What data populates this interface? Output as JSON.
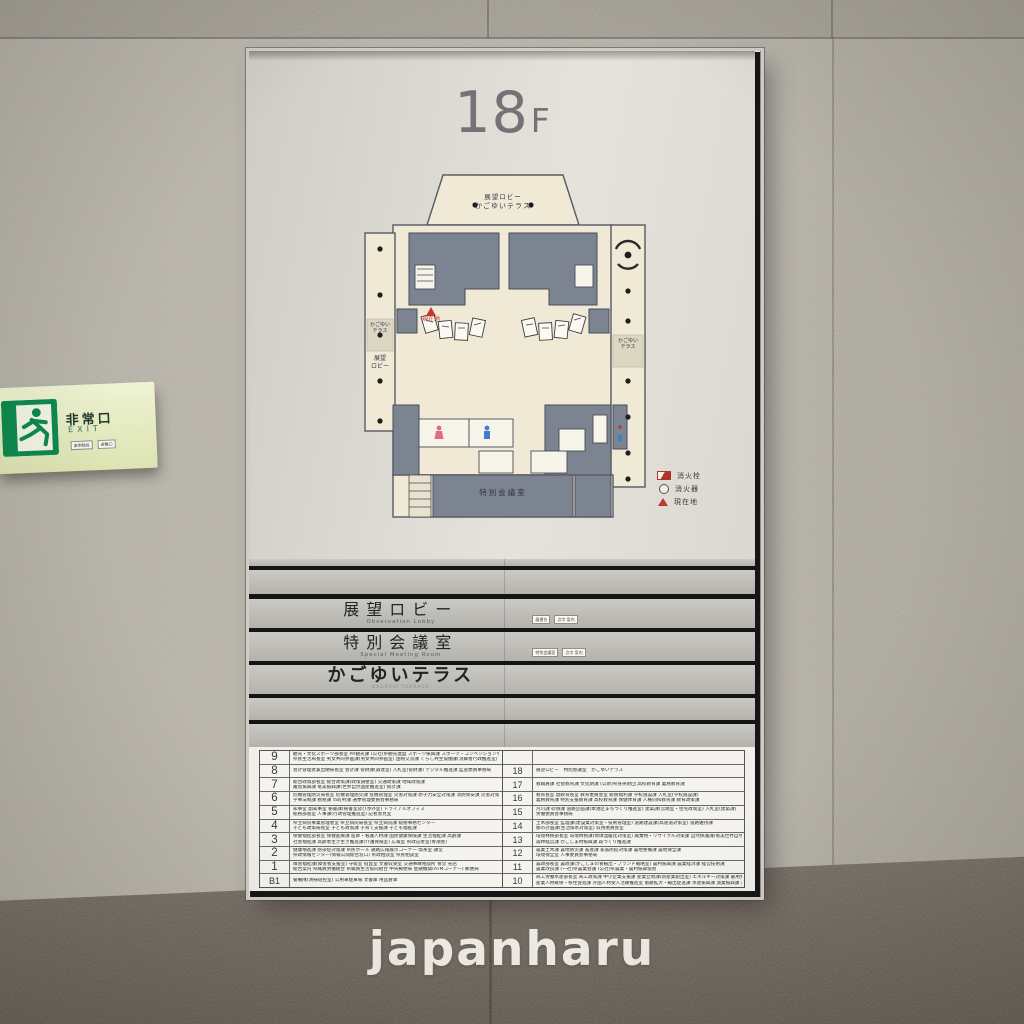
{
  "watermark": "japanharu",
  "colors": {
    "wall": "#b7b3aa",
    "wall_dark_band": "#6f6860",
    "sign_panel": "#dbd8d1",
    "plan_paper": "#efe9d6",
    "room_gray": "#7c8492",
    "safety_red": "#bf3a2b",
    "exit_green": "#0c8a4e",
    "exit_plate": "#e7edc2"
  },
  "exit_sign": {
    "jp": "非常口",
    "en": "EXIT",
    "tags": [
      "東側階段",
      "避難口"
    ]
  },
  "sign": {
    "floor_title": {
      "number": "18",
      "suffix": "F"
    },
    "floorplan": {
      "labels": {
        "top_line1": "展望ロビー",
        "top_line2": "かごゆいテラス",
        "current_location": "現在地",
        "left_terrace": "かごゆい\nテラス",
        "left_lobby": "展望\nロビー",
        "right_terrace": "かごゆい\nテラス",
        "meeting_room": "特別会議室"
      },
      "legend": [
        {
          "icon": "fire-hydrant",
          "label": "消火栓"
        },
        {
          "icon": "fire-extinguisher",
          "label": "消火器"
        },
        {
          "icon": "current-location",
          "label": "現在地"
        }
      ]
    },
    "nameplates": [
      {
        "jp": "展望ロビー",
        "en": "Observation Lobby",
        "tags": [
          "展望台",
          "点字 案内"
        ]
      },
      {
        "jp": "特別会議室",
        "en": "Special Meeting Room",
        "tags": [
          "特別会議室",
          "点字 案内"
        ]
      },
      {
        "jp": "かごゆいテラス",
        "en": "KAGOYUI TERRACE",
        "tags": []
      }
    ],
    "directory": {
      "left": [
        {
          "floor": "9",
          "lines": [
            "観光・文化スポーツ部長室 PR観光課 (公社)県観光連盟 スポーツ振興課 スポーツ・コンベンションセンター整備課 文化振興課(世界文化遺産室)",
            "県民生活局長室 男女共同参画課(男女共同参画室) 国際交流課 くらし共生協働課(消費者行政推進室) 人権同和対策課"
          ]
        },
        {
          "floor": "8",
          "lines": [
            "会計管理者兼出納局長室 会計課 管財課(調達室) 入札室(管財課) デジタル推進課 監査委員事務局"
          ]
        },
        {
          "floor": "7",
          "lines": [
            "総合政策部長室 総合政策課(政策調整室) 交通政策課 地域政策課",
            "離島振興課 奄美振興課(世界自然遺産推進室) 統計課"
          ]
        },
        {
          "floor": "6",
          "lines": [
            "危機管理防災局長室 危機管理防災課 危機管理室 災害対策課 原子力安全対策課 消防保安課 災害対策本部会議室",
            "学事法制課 税務課 市町村課 選挙管理委員会事務局"
          ]
        },
        {
          "floor": "5",
          "lines": [
            "知事室 副知事室 秘書課(秘書室及び渉外室) トライアルオフィス",
            "総務部長室 人事課(行政管理推進室) 記者会見室"
          ]
        },
        {
          "floor": "4",
          "lines": [
            "県立病院事業管理者室 県立病院局長室 県立病院課 総務事務センター",
            "子ども政策局長室 子ども政策課 子育て支援課 子ども福祉課"
          ]
        },
        {
          "floor": "3",
          "lines": [
            "保健福祉部長室 保健医療課 医師・看護人材課 国民健康保険課 生活福祉課 高齢課",
            "社会福祉課 高齢者生き生き推進課(介護保険室) 広報室 県政記者室(青潮会)"
          ]
        },
        {
          "floor": "2",
          "lines": [
            "健康増進課 感染症対策課 県民ホール 通路広報展示コーナー 喫茶室 講堂",
            "県政情報センター(情報公開総合窓口) 県政相談室 県民相談室"
          ]
        },
        {
          "floor": "1",
          "lines": [
            "障害福祉課(障害者支援室) 守衛室 宿直室 文書収受室 交通事故相談所 食堂 売店",
            "総合案内 県職員労働組合 県職員生活協同組合 中央郵便局 金融機関(ATMコーナー) 郵便局"
          ]
        },
        {
          "floor": "B1",
          "lines": [
            "警備隊(清掃班控室) 公用車駐車場 文書庫 用品倉庫"
          ]
        }
      ],
      "right": [
        {
          "floor": "",
          "lines": []
        },
        {
          "floor": "18",
          "lines": [
            "展望ロビー　特別会議室　かごゆいテラス"
          ]
        },
        {
          "floor": "17",
          "lines": [
            "教職員課 社会教育課 文化財課 (公財)県育英財団 高校教育課 義務教育課"
          ]
        },
        {
          "floor": "16",
          "lines": [
            "教育長室 副教育長室 教育委員会室 総務福利課 学校施設課 入札室(学校施設課)",
            "義務教育課 特別支援教育課 高校教育課 保健体育課 人権同和教育課 教育政策課"
          ]
        },
        {
          "floor": "15",
          "lines": [
            "河川課 砂防課 道路企画課(本港区まちづくり推進室) 建築課(営繕室・住宅政策室) 入札室(建築課)",
            "労働委員会事務局"
          ]
        },
        {
          "floor": "14",
          "lines": [
            "土木部長室 監理課(建設業対策室・技術管理室) 道路建設課(高速道対策室) 道路維持課",
            "都市計画課(生活排水対策室) 収用委員会室"
          ]
        },
        {
          "floor": "13",
          "lines": [
            "環境林務部長室 環境林務課(地球温暖化対策室) 廃棄物・リサイクル対策課 自然保護課(奄美世界自然遺産室)",
            "森林経営課 かごしま材振興課 森づくり推進課"
          ]
        },
        {
          "floor": "12",
          "lines": [
            "農業土木課 農地防災課 畜産課 家畜防疫対策課 農地整備課 農地保全課",
            "環境保全室 人事委員会事務局"
          ]
        },
        {
          "floor": "11",
          "lines": [
            "農政部長室 農政課(かごしまの食輸出・ブランド戦略室) 農村振興課 農業経済課 経営技術課",
            "農業改良課 (一社)県農業会議 (公社)県農業・農村振興協会"
          ]
        },
        {
          "floor": "10",
          "lines": [
            "商工労働水産部長室 商工政策課 中小企業支援課 産業立地課(新産業創出室) エネルギー対策課 雇用労政課",
            "産業人材確保・移住促進課 外国人材受入活躍推進室 販路拡大・輸出促進課 水産振興課 漁業振興課 海区漁業調整委員会室"
          ]
        }
      ]
    }
  }
}
